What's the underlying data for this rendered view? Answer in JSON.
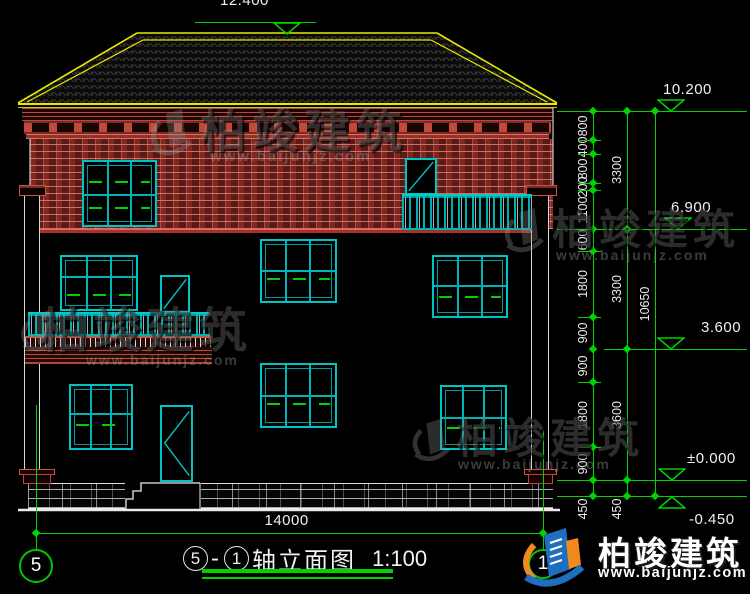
{
  "colors": {
    "green": "#00d400",
    "teal": "#00c4c4",
    "yellow": "#e8e800",
    "red": "#c23b3b",
    "white": "#f0f0f0",
    "logo_blue": "#1e6fbe",
    "logo_orange": "#f08a1e"
  },
  "elevation_markers": [
    {
      "label": "12.400",
      "y": 22,
      "x1": 195,
      "x2": 316,
      "tri_x": 287,
      "tri": "below",
      "text_x": 220,
      "text_pos": "above"
    },
    {
      "label": "10.200",
      "y": 111,
      "x1": 557,
      "x2": 747,
      "tri_x": 671,
      "tri": "above",
      "text_x": 663,
      "text_pos": "above"
    },
    {
      "label": "6.900",
      "y": 229,
      "x1": 557,
      "x2": 747,
      "tri_x": 678,
      "tri": "above",
      "text_x": 671,
      "text_pos": "above"
    },
    {
      "label": "3.600",
      "y": 349,
      "x1": 604,
      "x2": 747,
      "tri_x": 671,
      "tri": "above",
      "text_x": 701,
      "text_pos": "above"
    },
    {
      "label": "±0.000",
      "y": 480,
      "x1": 557,
      "x2": 747,
      "tri_x": 672,
      "tri": "above",
      "text_x": 687,
      "text_pos": "above"
    },
    {
      "label": "-0.450",
      "y": 496,
      "x1": 557,
      "x2": 747,
      "tri_x": 672,
      "tri": "belowflip",
      "text_x": 689,
      "text_pos": "below"
    }
  ],
  "right_dims": [
    {
      "x": 593,
      "points": [
        111,
        140,
        154,
        183,
        190,
        229,
        251,
        317,
        349,
        382,
        447,
        480,
        496
      ],
      "labels": [
        "800",
        "400",
        "800",
        "200",
        "1100",
        "600",
        "1800",
        "900",
        "900",
        "1800",
        "900",
        "450"
      ]
    },
    {
      "x": 627,
      "points": [
        111,
        229,
        349,
        480,
        496
      ],
      "labels": [
        "3300",
        "3300",
        "3600",
        "450"
      ]
    },
    {
      "x": 655,
      "points": [
        111,
        496
      ],
      "labels": [
        "10650"
      ]
    }
  ],
  "ext_lines": [
    {
      "y": 140,
      "x1": 578,
      "x2": 601
    },
    {
      "y": 154,
      "x1": 578,
      "x2": 601
    },
    {
      "y": 183,
      "x1": 578,
      "x2": 601
    },
    {
      "y": 190,
      "x1": 578,
      "x2": 601
    },
    {
      "y": 251,
      "x1": 578,
      "x2": 601
    },
    {
      "y": 317,
      "x1": 578,
      "x2": 601
    },
    {
      "y": 382,
      "x1": 578,
      "x2": 601
    },
    {
      "y": 447,
      "x1": 578,
      "x2": 601
    }
  ],
  "bottom_dim": {
    "label": "14000",
    "y": 533,
    "x1": 36,
    "x2": 543
  },
  "axes": [
    {
      "label": "5",
      "cx": 36,
      "cy": 566,
      "r": 17,
      "line_y1": 405
    },
    {
      "label": "1",
      "cx": 543,
      "cy": 564,
      "r": 15,
      "line_y1": 430
    }
  ],
  "title": {
    "axis_start": "5",
    "dash": "-",
    "axis_end": "1",
    "text": "轴立面图",
    "scale": "1:100"
  },
  "watermark": {
    "brand": "柏竣建筑",
    "url": "www.baijunjz.com"
  },
  "logo": {
    "brand": "柏竣建筑",
    "url": "www.baijunjz.com"
  }
}
